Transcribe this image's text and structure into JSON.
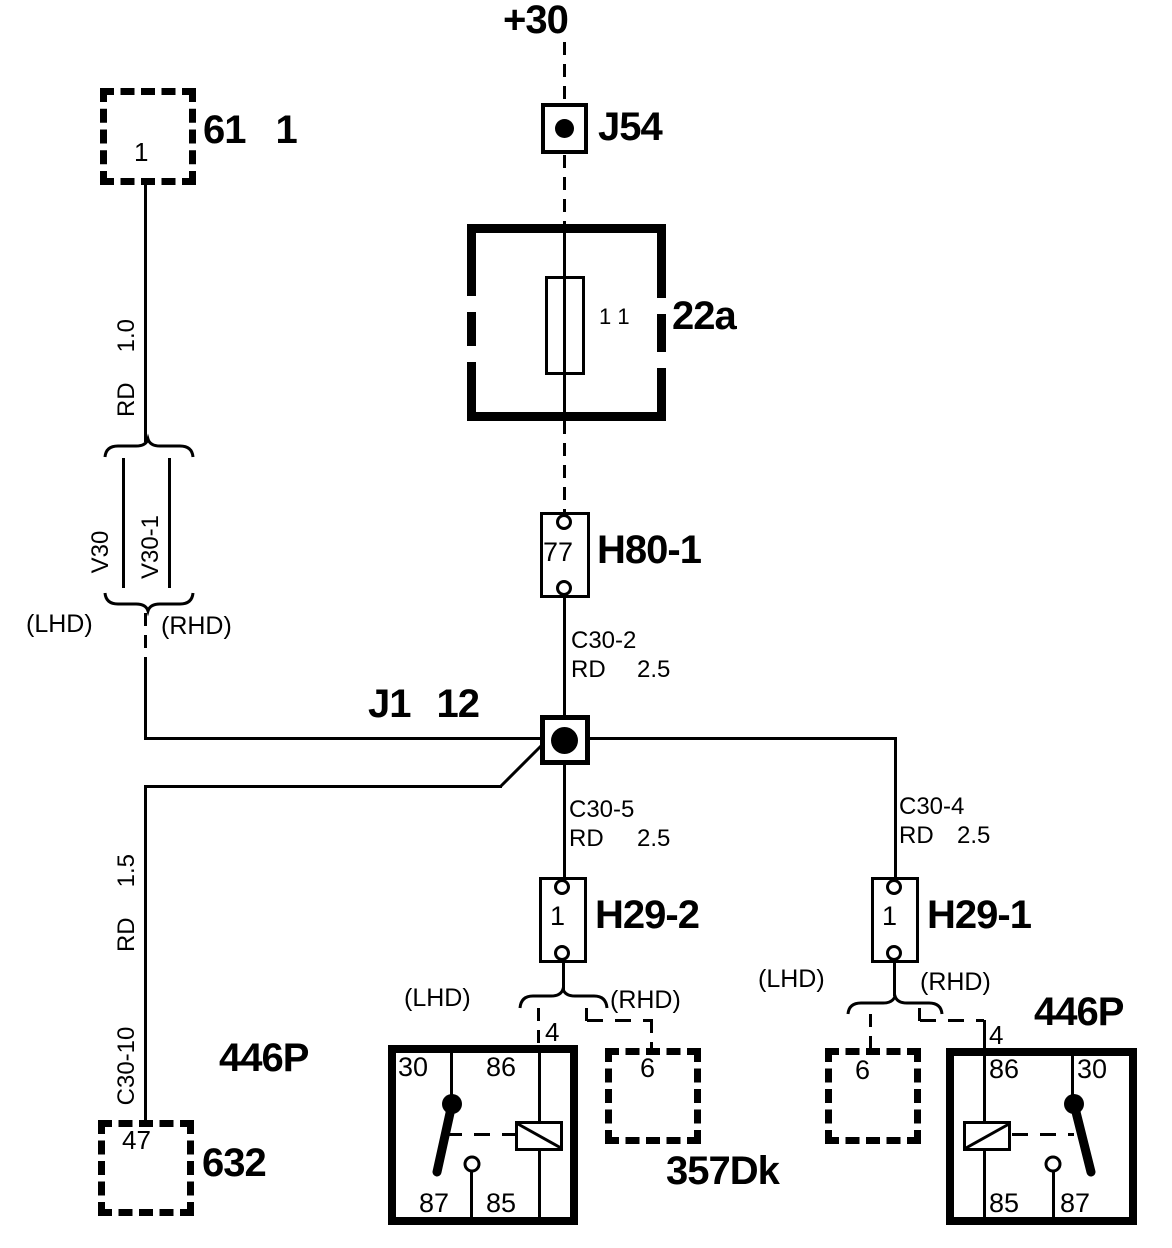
{
  "colors": {
    "ink": "#000000",
    "paper": "#ffffff"
  },
  "power_feed": {
    "label": "+30"
  },
  "j54": {
    "label": "J54"
  },
  "conn_61": {
    "label": "61",
    "ref": "1",
    "pin": "1"
  },
  "fuse_22a": {
    "label": "22a",
    "pins": "1 1"
  },
  "h80_1": {
    "label": "H80-1",
    "pin": "77"
  },
  "j1": {
    "label": "J1",
    "ref": "12"
  },
  "h29_2": {
    "label": "H29-2",
    "pin": "1"
  },
  "h29_1": {
    "label": "H29-1",
    "pin": "1"
  },
  "conn_632": {
    "label": "632",
    "pin": "47"
  },
  "conn_357dk": {
    "label": "357Dk",
    "pin_mid": "6",
    "pin_right": "6"
  },
  "relay_left": {
    "label": "446P",
    "feed_pin": "4",
    "pin_tl": "30",
    "pin_tr": "86",
    "pin_bl": "87",
    "pin_br": "85"
  },
  "relay_right": {
    "label": "446P",
    "feed_pin": "4",
    "pin_tl": "86",
    "pin_tr": "30",
    "pin_bl": "85",
    "pin_br": "87"
  },
  "wires": {
    "rd_10": {
      "color": "RD",
      "gauge": "1.0"
    },
    "rd_15": {
      "color": "RD",
      "gauge": "1.5",
      "pin": "C30-10"
    },
    "c30_2": {
      "pin": "C30-2",
      "color": "RD",
      "gauge": "2.5"
    },
    "c30_5": {
      "pin": "C30-5",
      "color": "RD",
      "gauge": "2.5"
    },
    "c30_4": {
      "pin": "C30-4",
      "color": "RD",
      "gauge": "2.5"
    }
  },
  "harness": {
    "v30": "V30",
    "v30_1": "V30-1"
  },
  "variant_labels": {
    "lhd": "(LHD)",
    "rhd": "(RHD)"
  }
}
